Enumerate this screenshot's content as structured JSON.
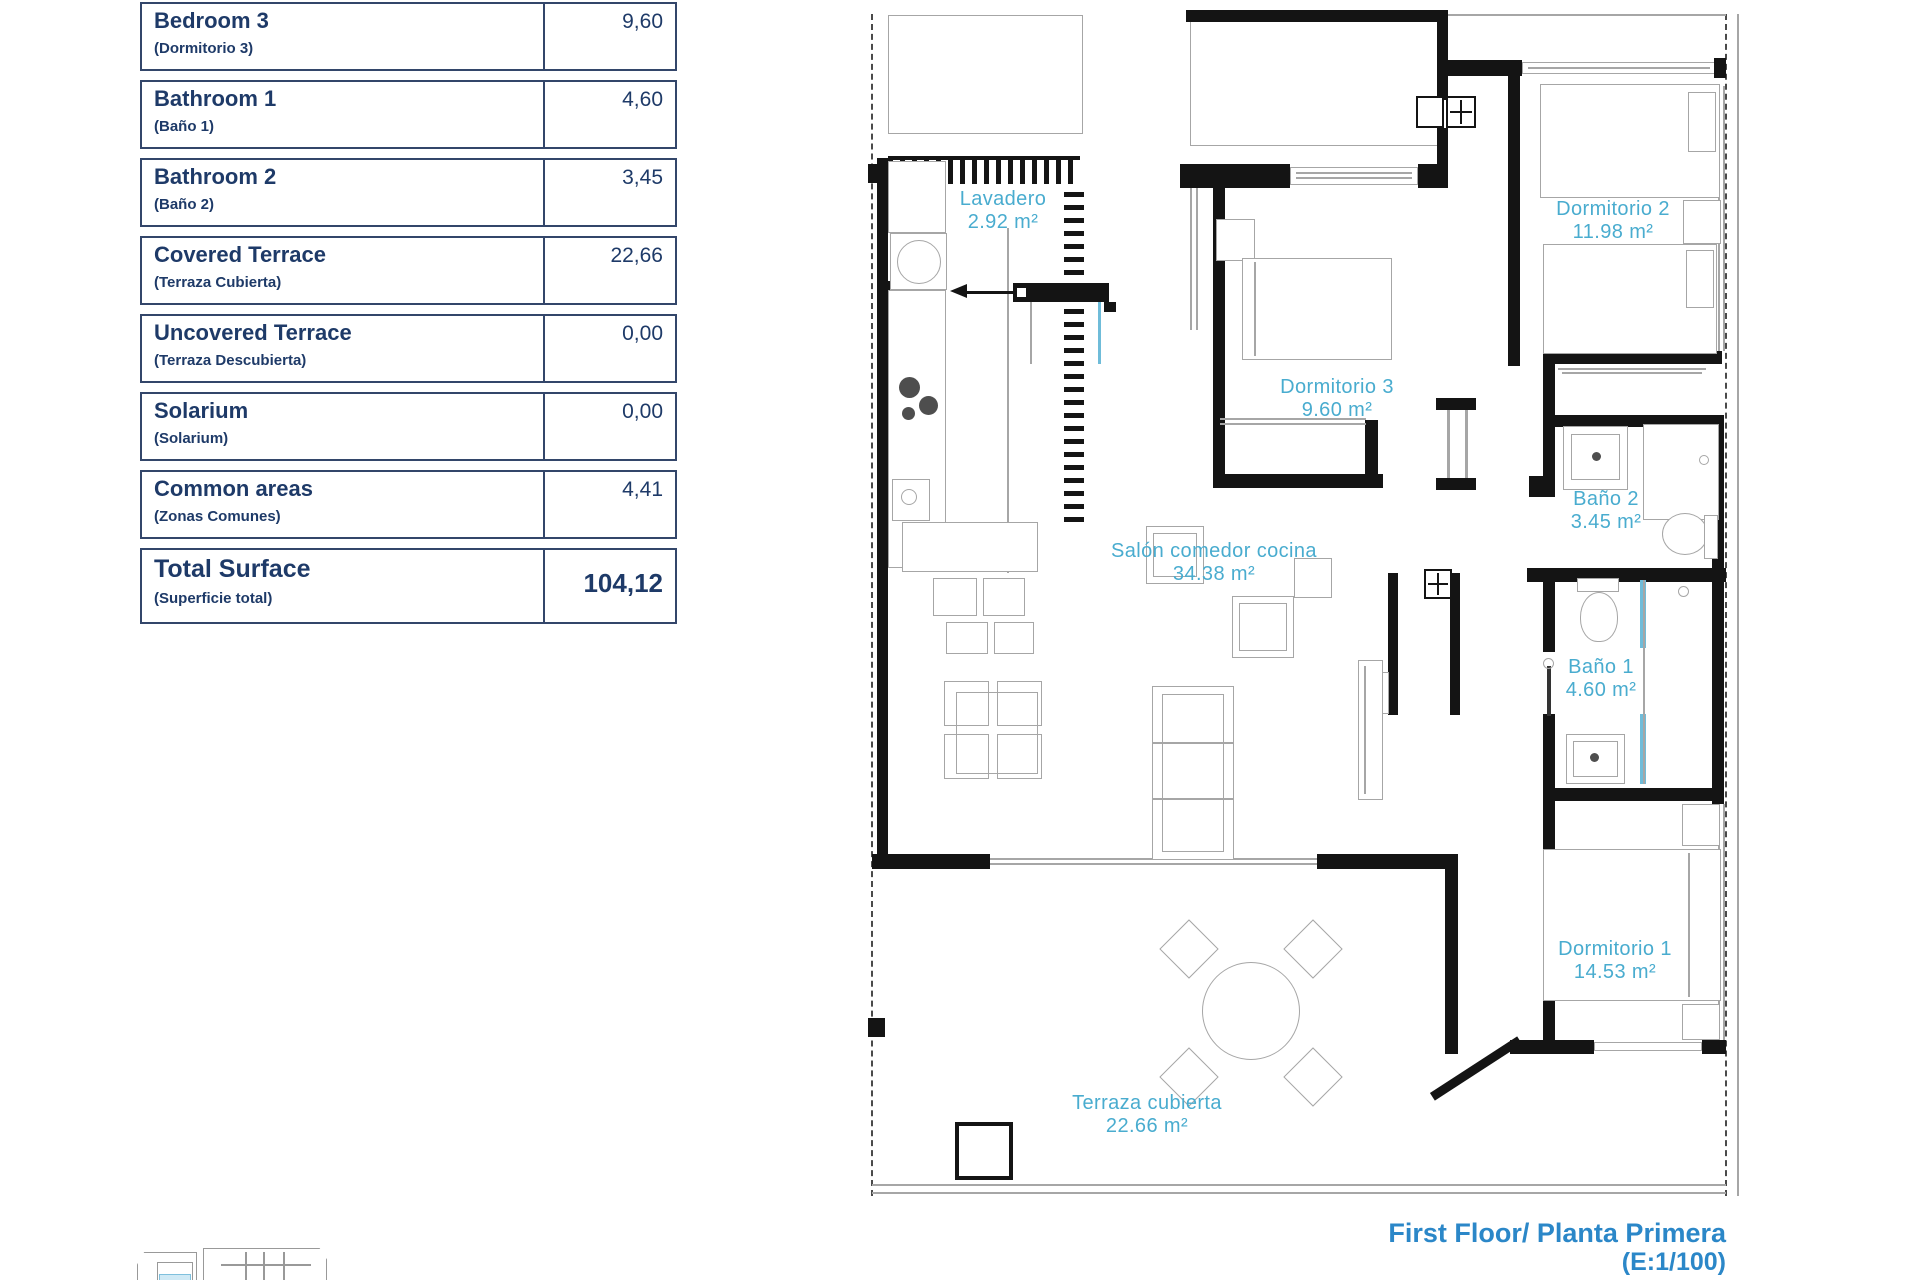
{
  "table": {
    "rows": [
      {
        "label_en": "Bedroom 3",
        "label_es": "(Dormitorio 3)",
        "value": "9,60"
      },
      {
        "label_en": "Bathroom 1",
        "label_es": "(Baño 1)",
        "value": "4,60"
      },
      {
        "label_en": "Bathroom 2",
        "label_es": "(Baño 2)",
        "value": "3,45"
      },
      {
        "label_en": "Covered Terrace",
        "label_es": "(Terraza Cubierta)",
        "value": "22,66"
      },
      {
        "label_en": "Uncovered Terrace",
        "label_es": "(Terraza Descubierta)",
        "value": "0,00"
      },
      {
        "label_en": "Solarium",
        "label_es": "(Solarium)",
        "value": "0,00"
      },
      {
        "label_en": "Common areas",
        "label_es": "(Zonas Comunes)",
        "value": "4,41"
      }
    ],
    "total": {
      "label_en": "Total Surface",
      "label_es": "(Superficie total)",
      "value": "104,12"
    }
  },
  "plan": {
    "rooms": [
      {
        "id": "lavadero",
        "name": "Lavadero",
        "area": "2.92 m²"
      },
      {
        "id": "dormitorio-2",
        "name": "Dormitorio 2",
        "area": "11.98 m²"
      },
      {
        "id": "dormitorio-3",
        "name": "Dormitorio 3",
        "area": "9.60 m²"
      },
      {
        "id": "bano-2",
        "name": "Baño 2",
        "area": "3.45 m²"
      },
      {
        "id": "salon",
        "name": "Salón comedor cocina",
        "area": "34.38 m²"
      },
      {
        "id": "bano-1",
        "name": "Baño 1",
        "area": "4.60 m²"
      },
      {
        "id": "dormitorio-1",
        "name": "Dormitorio 1",
        "area": "14.53 m²"
      },
      {
        "id": "terraza",
        "name": "Terraza cubierta",
        "area": "22.66 m²"
      }
    ]
  },
  "footer": {
    "title": "First Floor/ Planta Primera",
    "scale": "(E:1/100)"
  },
  "colors": {
    "room_label_blue": "#49accf",
    "table_navy": "#1e3a68",
    "table_border": "#33466a",
    "footer_blue": "#2b87c8",
    "wall_black": "#141414",
    "furniture_gray": "#a6a6a6",
    "glass_blue": "#6fbcd9"
  }
}
